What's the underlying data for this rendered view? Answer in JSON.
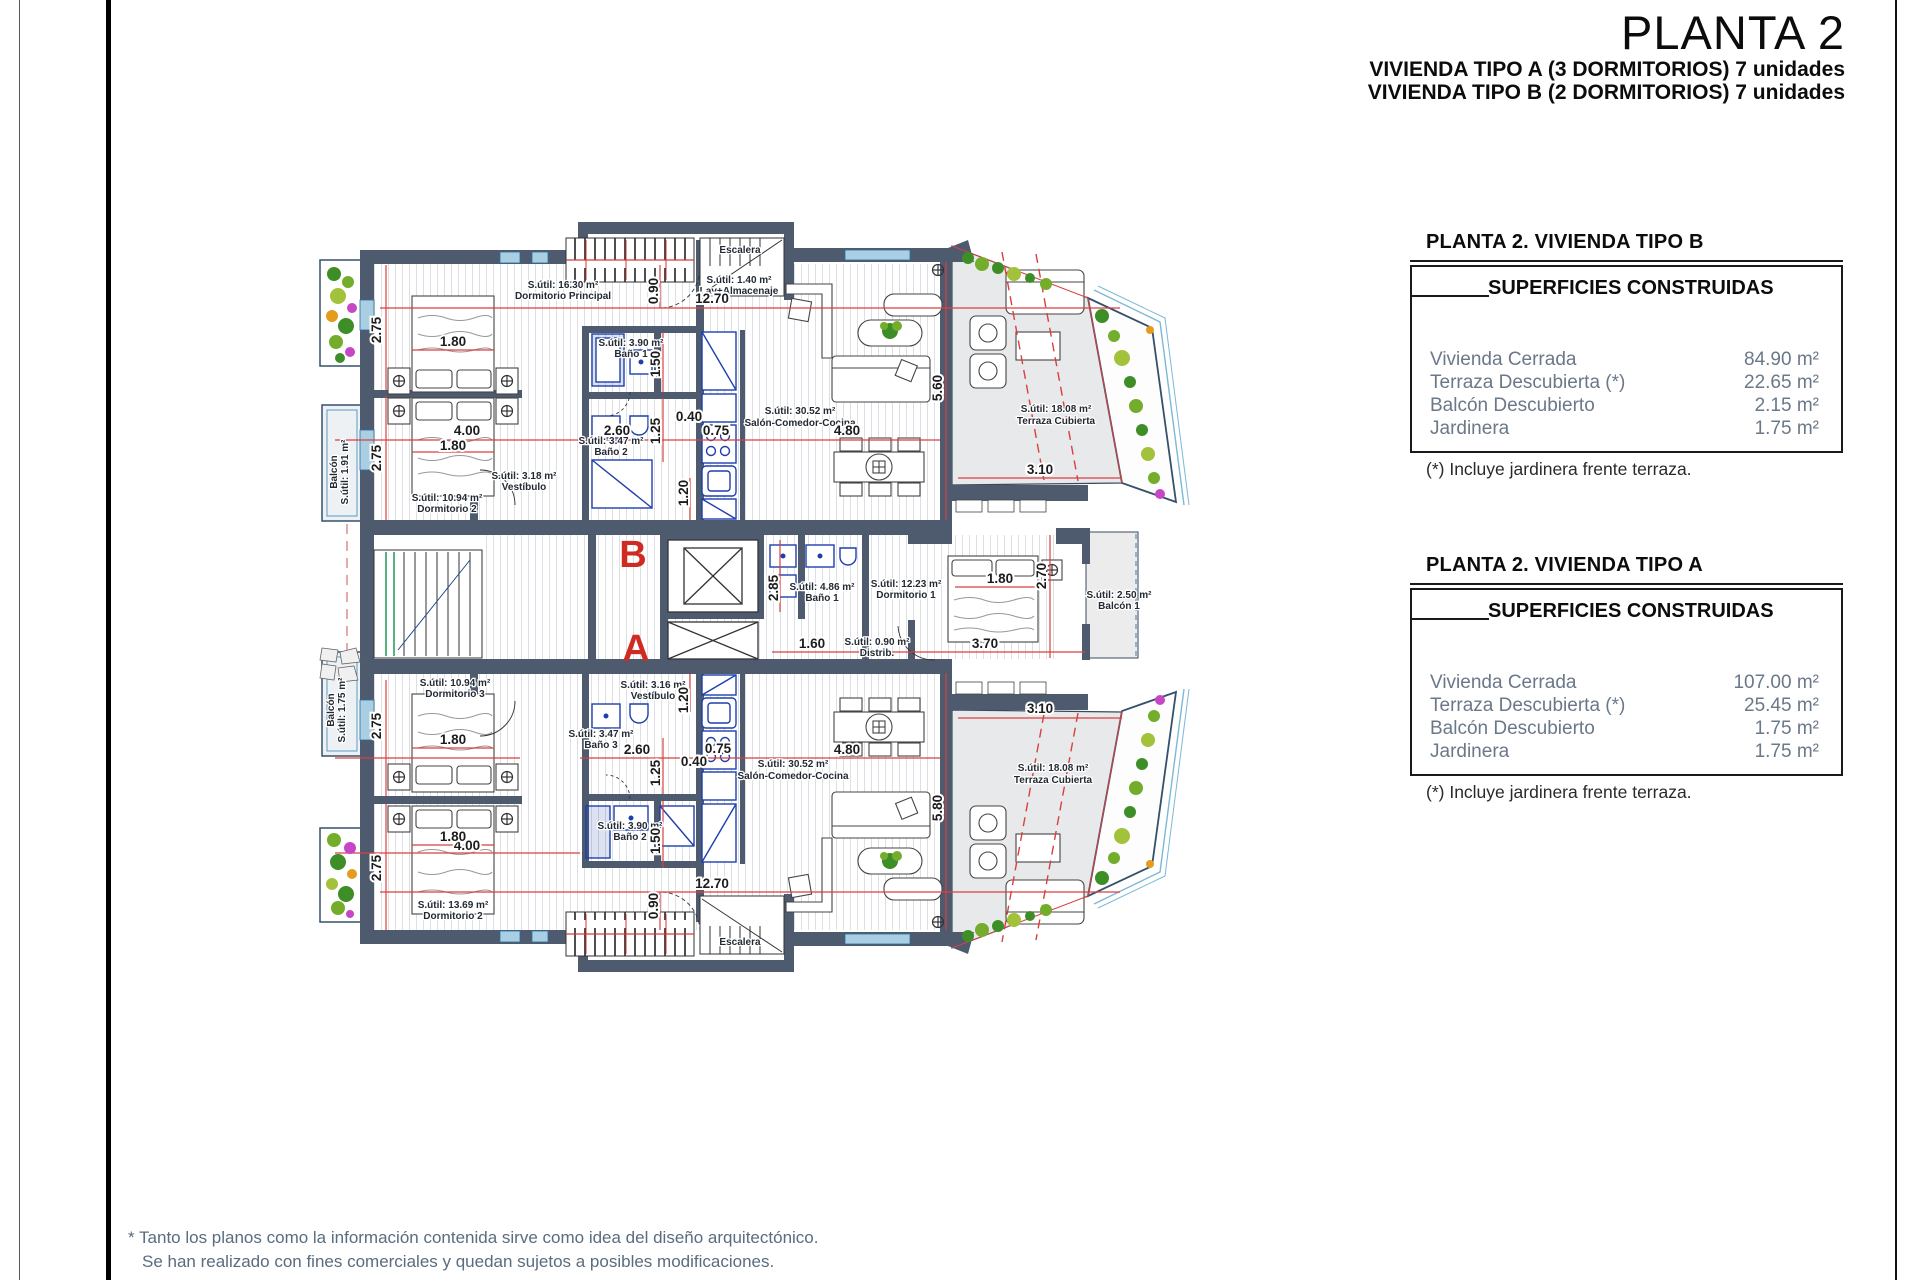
{
  "title": "PLANTA 2",
  "subtitles": {
    "a": "VIVIENDA TIPO A (3 DORMITORIOS) 7 unidades",
    "b": "VIVIENDA TIPO B (2 DORMITORIOS) 7 unidades"
  },
  "tables": [
    {
      "heading": "PLANTA 2. VIVIENDA TIPO B",
      "box_title": "SUPERFICIES CONSTRUIDAS",
      "rows": [
        {
          "label": "Vivienda Cerrada",
          "value": "84.90 m²"
        },
        {
          "label": "Terraza Descubierta (*)",
          "value": "22.65 m²"
        },
        {
          "label": "Balcón Descubierto",
          "value": "2.15 m²"
        },
        {
          "label": "Jardinera",
          "value": "1.75 m²"
        }
      ],
      "footnote": "(*) Incluye jardinera frente terraza."
    },
    {
      "heading": "PLANTA 2. VIVIENDA TIPO A",
      "box_title": "SUPERFICIES CONSTRUIDAS",
      "rows": [
        {
          "label": "Vivienda Cerrada",
          "value": "107.00 m²"
        },
        {
          "label": "Terraza Descubierta (*)",
          "value": "25.45 m²"
        },
        {
          "label": "Balcón Descubierto",
          "value": "1.75 m²"
        },
        {
          "label": "Jardinera",
          "value": "1.75 m²"
        }
      ],
      "footnote": "(*) Incluye jardinera frente terraza."
    }
  ],
  "footer_lines": [
    "* Tanto los planos como la información contenida sirve como idea del diseño arquitectónico.",
    "Se han realizado con fines comerciales y quedan sujetos a posibles modificaciones."
  ],
  "plan": {
    "letters": {
      "b": "B",
      "a": "A"
    },
    "rooms": {
      "dormPrincipal": {
        "l1": "S.útil: 16.30 m²",
        "l2": "Dormitorio Principal"
      },
      "bano1B": {
        "l1": "S.útil: 3.90 m²",
        "l2": "Baño 1"
      },
      "bano2B": {
        "l1": "S.útil: 3.47 m²",
        "l2": "Baño 2"
      },
      "dorm2B": {
        "l1": "S.útil: 10.94 m²",
        "l2": "Dormitorio 2"
      },
      "vestibuloB": {
        "l1": "S.útil: 3.18 m²",
        "l2": "Vestíbulo"
      },
      "lav": {
        "l1": "S.útil: 1.40 m²",
        "l2": "Lav+Almacenaje"
      },
      "escaleraTop": "Escalera",
      "salonB": {
        "l1": "S.útil: 30.52 m²",
        "l2": "Salón-Comedor-Cocina"
      },
      "terrazaB": {
        "l1": "S.útil: 18.08 m²",
        "l2": "Terraza Cubierta"
      },
      "balconB": {
        "l1": "Balcón",
        "l2": "S.útil: 1.91 m²"
      },
      "bano1A": {
        "l1": "S.útil: 4.86 m²",
        "l2": "Baño 1"
      },
      "dorm1A": {
        "l1": "S.útil: 12.23 m²",
        "l2": "Dormitorio 1"
      },
      "distrib": {
        "l1": "S.útil: 0.90 m²",
        "l2": "Distrib."
      },
      "balcon1A": {
        "l1": "S.útil: 2.50 m²",
        "l2": "Balcón 1"
      },
      "dorm3A": {
        "l1": "S.útil: 10.94 m²",
        "l2": "Dormitorio 3"
      },
      "bano3A": {
        "l1": "S.útil: 3.47 m²",
        "l2": "Baño 3"
      },
      "vestibuloA": {
        "l1": "S.útil: 3.16 m²",
        "l2": "Vestíbulo"
      },
      "bano2A": {
        "l1": "S.útil: 3.90 m²",
        "l2": "Baño 2"
      },
      "dorm2A": {
        "l1": "S.útil: 13.69 m²",
        "l2": "Dormitorio 2"
      },
      "salonA": {
        "l1": "S.útil: 30.52 m²",
        "l2": "Salón-Comedor-Cocina"
      },
      "escaleraBottom": "Escalera",
      "terrazaA": {
        "l1": "S.útil: 18.08 m²",
        "l2": "Terraza Cubierta"
      },
      "balconA": {
        "l1": "Balcón",
        "l2": "S.útil: 1.75 m²"
      }
    },
    "dims": {
      "t1270": "12.70",
      "t090": "0.90",
      "t275a": "2.75",
      "t275b": "2.75",
      "t180a": "1.80",
      "t400": "4.00",
      "t180b": "1.80",
      "t150": "1.50",
      "t125": "1.25",
      "t040": "0.40",
      "t075": "0.75",
      "t120": "1.20",
      "t260": "2.60",
      "t480": "4.80",
      "t560": "5.60",
      "t310": "3.10",
      "m285": "2.85",
      "m160": "1.60",
      "m370": "3.70",
      "m180": "1.80",
      "m270": "2.70",
      "b1270": "12.70",
      "b090": "0.90",
      "b275a": "2.75",
      "b275b": "2.75",
      "b180a": "1.80",
      "b400": "4.00",
      "b180b": "1.80",
      "b150": "1.50",
      "b125": "1.25",
      "b040": "0.40",
      "b075": "0.75",
      "b120": "1.20",
      "b260": "2.60",
      "b480": "4.80",
      "b580": "5.80",
      "b310": "3.10"
    }
  },
  "colors": {
    "wall": "#4e5b6f",
    "dimension_red": "#d84040",
    "unit_letter_red": "#cf2b20",
    "fixture_blue": "#1d3fae",
    "railing_blue": "#7cb8d8",
    "plant_green": "#3e8e28",
    "table_text_grey": "#6a7888"
  }
}
